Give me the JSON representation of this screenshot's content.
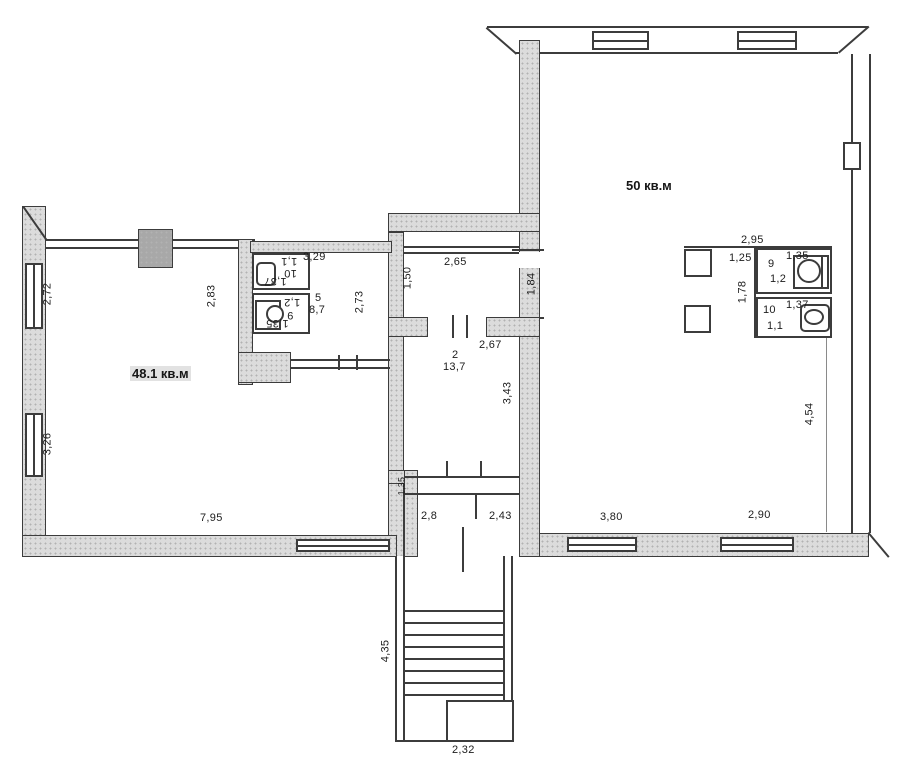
{
  "plan": {
    "big_room": {
      "area": "50 кв.м"
    },
    "left_room": {
      "area": "48.1 кв.м"
    },
    "room_2": {
      "number": "2",
      "area": "13,7"
    },
    "room_5": {
      "number": "5",
      "area": "8,7"
    },
    "wc_right": {
      "width_top": "2,95",
      "entry_width": "1,25",
      "inner_height": "1,78",
      "room_9": {
        "number": "9",
        "width": "1,35",
        "depth": "1,2"
      },
      "room_10": {
        "number": "10",
        "width": "1,37",
        "depth": "1,1"
      }
    },
    "wc_left": {
      "width_top": "3,29",
      "room_9": {
        "number": "9",
        "width": "1,35",
        "depth": "1,2"
      },
      "room_10": {
        "number": "10",
        "width": "1,37",
        "depth": "1,1"
      }
    },
    "dims": {
      "left_wall_window_top": "2,72",
      "left_wall_window_bottom": "3,26",
      "left_room_right": "2,83",
      "room5_right": "2,73",
      "left_room_bottom": "7,95",
      "room2_top": "2,65",
      "room2_left": "1,50",
      "room2_mid": "2,67",
      "room2_right": "3,43",
      "big_room_wall": "1,84",
      "vestibule_left": "1,35",
      "vestibule_bottom_left": "2,8",
      "vestibule_bottom_right": "2,43",
      "big_room_bottom_left": "3,80",
      "big_room_bottom_right": "2,90",
      "big_room_right": "4,54",
      "stairs_length": "4,35",
      "stairs_bottom": "2,32"
    }
  }
}
